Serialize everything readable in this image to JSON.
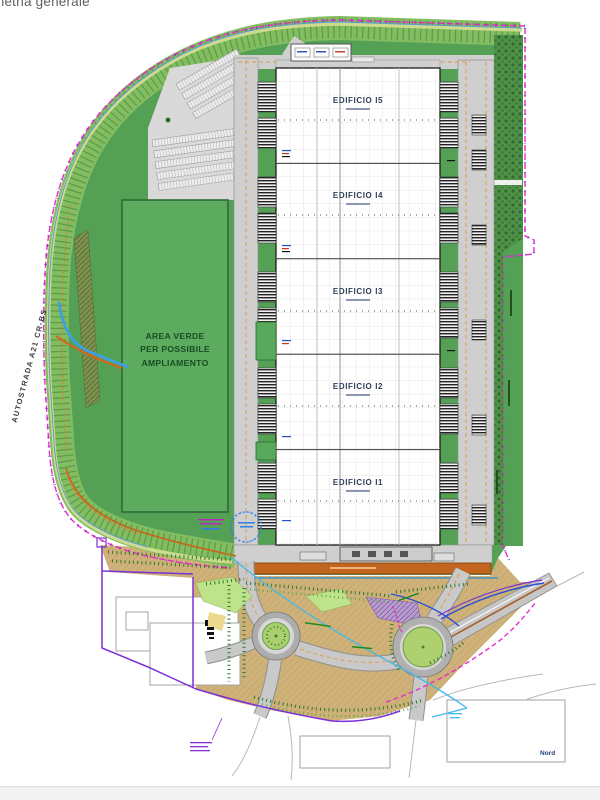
{
  "header": {
    "title_fragment": "metria generale"
  },
  "plan": {
    "highway_label": "AUTOSTRADA A21 CR-BS",
    "green_area_label": "AREA VERDE\nPER POSSIBILE\nAMPLIAMENTO",
    "north_label": "Nord",
    "buildings": [
      {
        "label": "EDIFICIO I5"
      },
      {
        "label": "EDIFICIO I4"
      },
      {
        "label": "EDIFICIO I3"
      },
      {
        "label": "EDIFICIO I2"
      },
      {
        "label": "EDIFICIO I1"
      }
    ],
    "colors": {
      "field_green": "#54a156",
      "embankment_green": "#82bd61",
      "area_verde_green": "#5cab5f",
      "boundary_magenta": "#ec28c8",
      "parcel_purple": "#7c2fd6",
      "road_gray": "#c9c9c9",
      "south_road_orange": "#c2661f",
      "agricultural_tan": "#cfb279",
      "water_cyan": "#41b9ec",
      "roundabout_green": "#aed06f"
    }
  }
}
